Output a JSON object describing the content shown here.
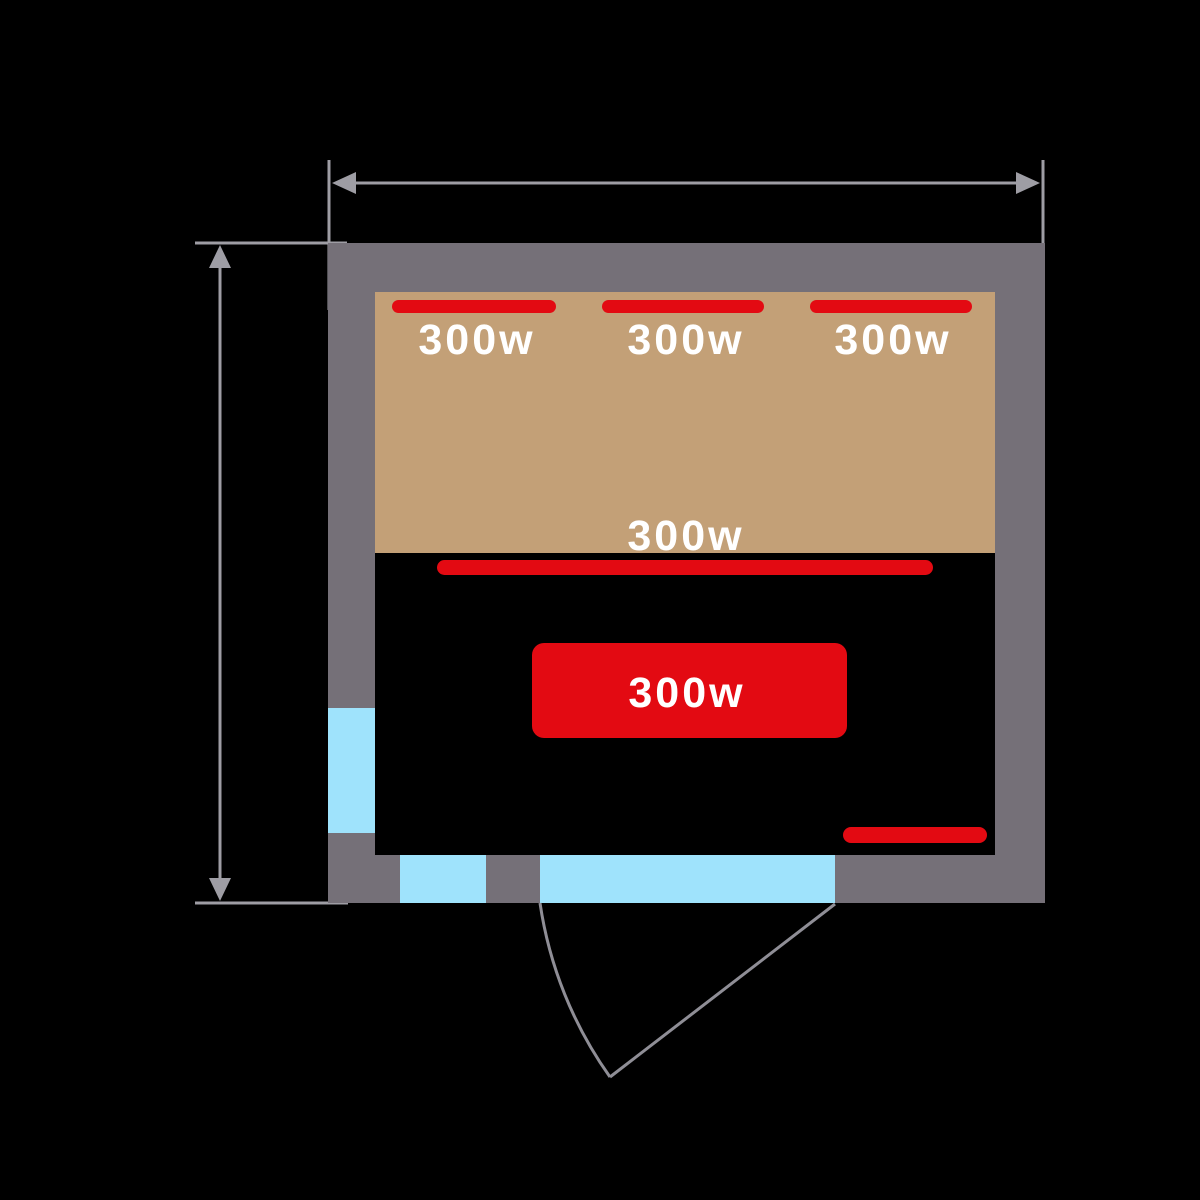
{
  "heaters": {
    "rear": [
      {
        "label": "300w"
      },
      {
        "label": "300w"
      },
      {
        "label": "300w"
      }
    ],
    "bench_front": {
      "label": "300w"
    },
    "floor_panel": {
      "label": "300w"
    }
  },
  "colors": {
    "background": "#000000",
    "wall": "#757078",
    "bench": "#c3a077",
    "floor": "#000000",
    "heater_red": "#e30a12",
    "glass_blue": "#9fe3fc",
    "dimension_line": "#9e9da4",
    "door_line": "#8f8e96",
    "label_text": "#ffffff"
  }
}
